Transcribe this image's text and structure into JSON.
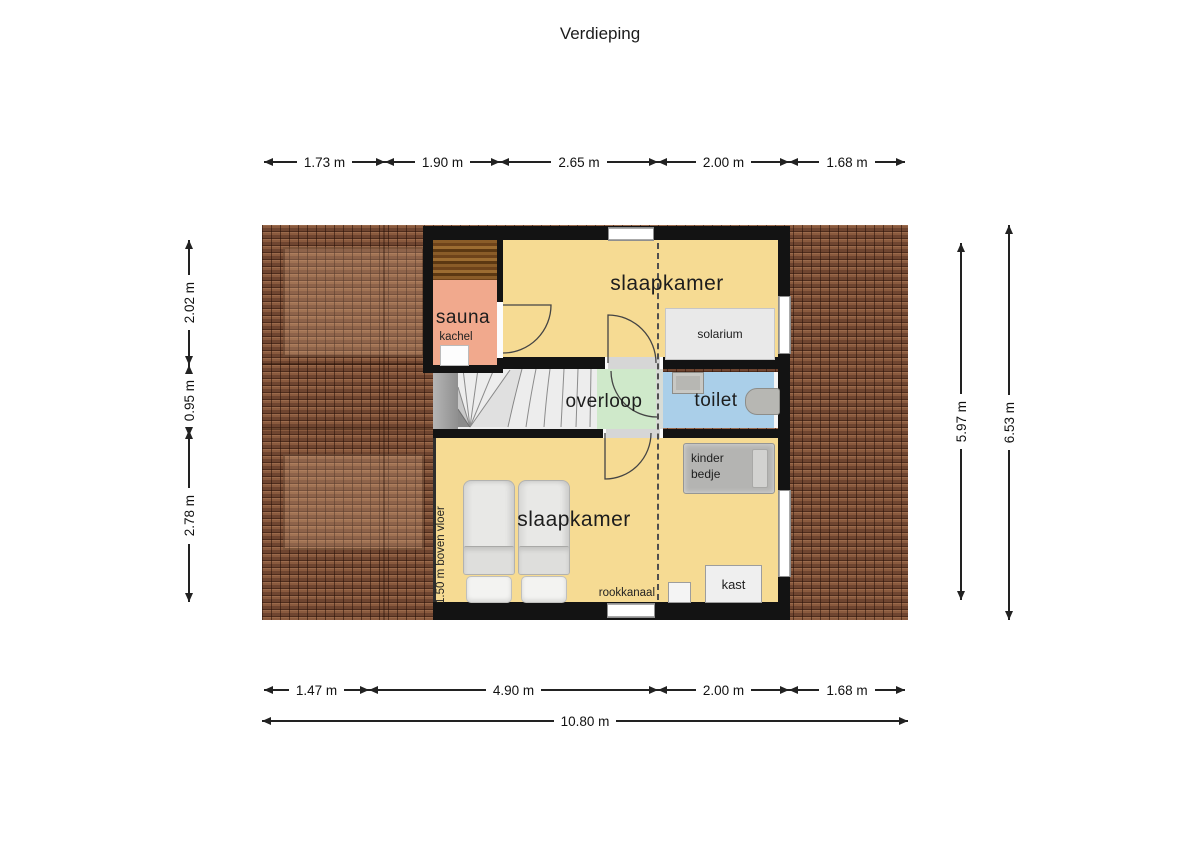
{
  "title": "Verdieping",
  "rooms": {
    "sauna": "sauna",
    "slaapkamer_top": "slaapkamer",
    "overloop": "overloop",
    "toilet": "toilet",
    "slaapkamer_bottom": "slaapkamer"
  },
  "furniture": {
    "kachel": "kachel",
    "solarium": "solarium",
    "kinder_bedje": "kinder bedje",
    "kast": "kast",
    "rookkanaal": "rookkanaal"
  },
  "annotations": {
    "height_note": "1.50 m boven vloer"
  },
  "dimensions": {
    "top": [
      "1.73 m",
      "1.90 m",
      "2.65 m",
      "2.00 m",
      "1.68 m"
    ],
    "left": [
      "2.02 m",
      "0.95 m",
      "2.78 m"
    ],
    "right_inner": "5.97 m",
    "right_outer": "6.53 m",
    "bottom": [
      "1.47 m",
      "4.90 m",
      "2.00 m",
      "1.68 m"
    ],
    "total_width": "10.80 m"
  },
  "colors": {
    "floor_yellow": "#f6db93",
    "sauna_salmon": "#f1a98d",
    "overloop_green": "#cfe9ca",
    "toilet_blue": "#aacfe9",
    "roof_brown": "#7d4e36",
    "wall_black": "#131313"
  }
}
